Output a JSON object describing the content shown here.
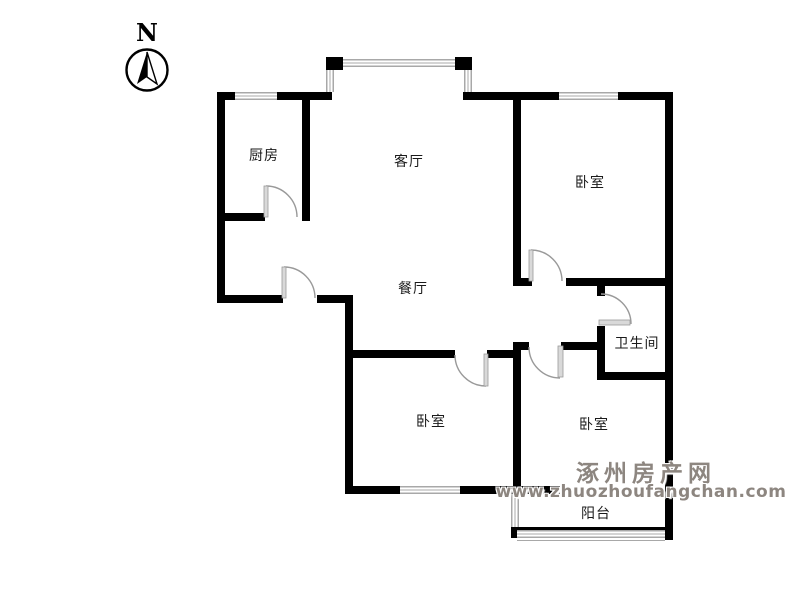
{
  "compass": {
    "label": "N"
  },
  "rooms": {
    "kitchen": "厨房",
    "living": "客厅",
    "bedroom_ne": "卧室",
    "dining": "餐厅",
    "bathroom": "卫生间",
    "bedroom_sw": "卧室",
    "bedroom_se": "卧室",
    "balcony": "阳台"
  },
  "watermark": {
    "site_name": "涿州房产网",
    "site_url": "www.zhuozhoufangchan.com"
  },
  "colors": {
    "wall": "#000000",
    "window_stripe": "#a8a8a8",
    "door": "#999999",
    "door_leaf": "#d9d9d9",
    "watermark": "#8d8680"
  }
}
